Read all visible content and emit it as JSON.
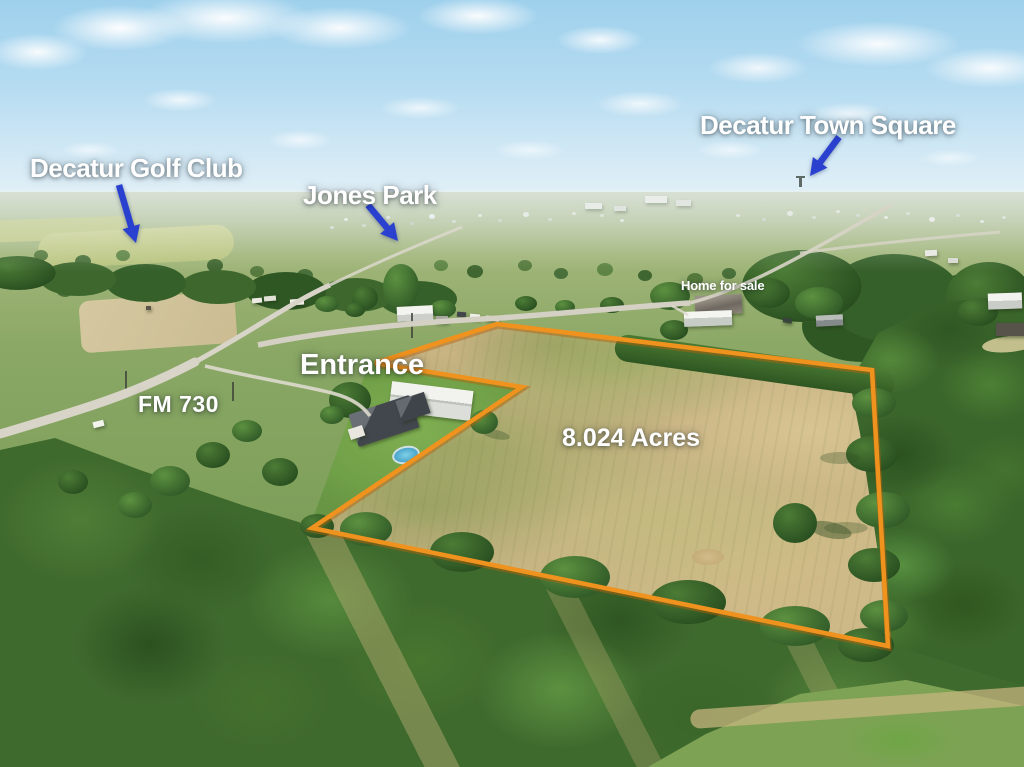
{
  "image": {
    "type": "aerial-drone-photo",
    "width": 1024,
    "height": 767,
    "subject": "8.024 acre land parcel for sale near Decatur"
  },
  "colors": {
    "boundary": "#F0921E",
    "boundary_shadow": "#B85F08",
    "arrow_blue": "#2A41D0",
    "label_white": "#FFFFFF"
  },
  "labels": {
    "golf_club": "Decatur Golf Club",
    "jones_park": "Jones Park",
    "town_square": "Decatur Town Square",
    "home_for_sale": "Home for sale",
    "entrance": "Entrance",
    "highway": "FM 730",
    "acreage": "8.024 Acres"
  },
  "annotations": {
    "boundary_points": [
      [
        497,
        324
      ],
      [
        872,
        370
      ],
      [
        888,
        646
      ],
      [
        312,
        528
      ],
      [
        522,
        387
      ],
      [
        375,
        363
      ]
    ],
    "arrows": [
      {
        "name": "golf-club-arrow",
        "from": [
          119,
          185
        ],
        "to": [
          136,
          243
        ]
      },
      {
        "name": "jones-park-arrow",
        "from": [
          368,
          205
        ],
        "to": [
          398,
          241
        ]
      },
      {
        "name": "town-square-arrow",
        "from": [
          839,
          137
        ],
        "to": [
          810,
          176
        ]
      }
    ]
  }
}
